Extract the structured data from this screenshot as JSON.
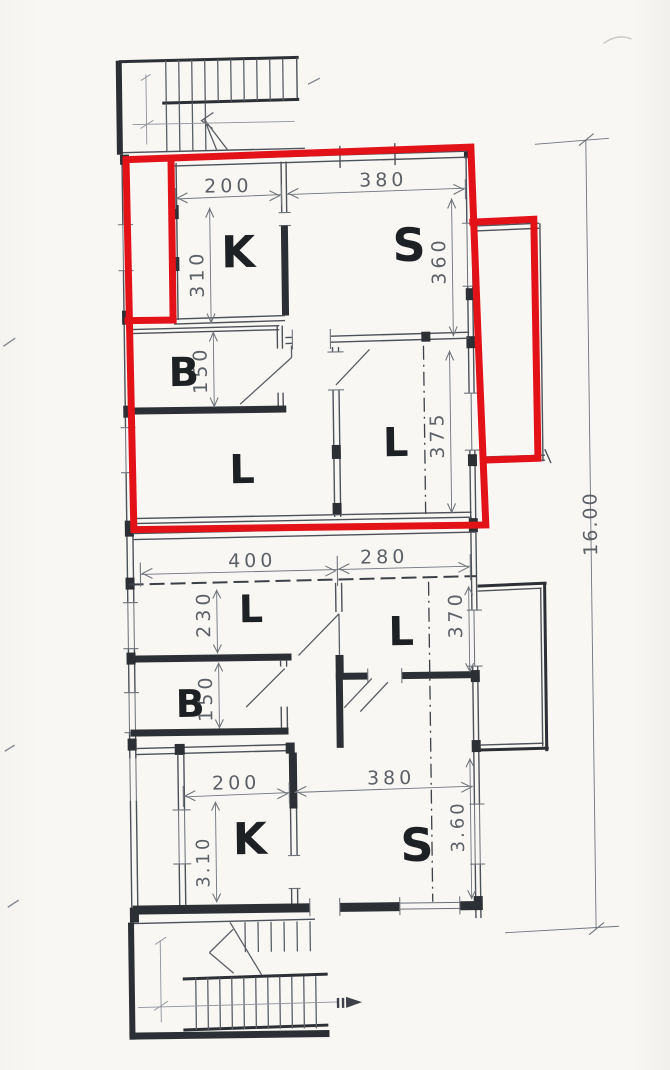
{
  "page": {
    "background": "#f8f7f3"
  },
  "colors": {
    "highlight_red": "#e31219",
    "pencil": "#4d5158",
    "pencil_dark": "#2c2f34",
    "dimension_gray": "#70757d",
    "letter_ink": "#1e2124"
  },
  "plan": {
    "unit_top": {
      "room_k": "K",
      "room_s": "S",
      "room_b": "B",
      "room_l_left": "L",
      "room_l_right": "L",
      "dim_k_width": "200",
      "dim_s_width": "380",
      "dim_k_depth": "310",
      "dim_s_depth": "360",
      "dim_b_depth": "150",
      "dim_l_right_depth": "375"
    },
    "unit_bottom": {
      "room_l_left": "L",
      "room_l_right": "L",
      "room_b": "B",
      "room_k": "K",
      "room_s": "S",
      "dim_l_width": "400",
      "dim_l_right_width": "280",
      "dim_l_left_depth": "230",
      "dim_l_right_depth": "370",
      "dim_b_depth": "150",
      "dim_k_width": "200",
      "dim_s_width": "380",
      "dim_k_depth": "3.10",
      "dim_s_depth": "3.60"
    },
    "overall": {
      "dim_building_length": "16.00"
    }
  }
}
